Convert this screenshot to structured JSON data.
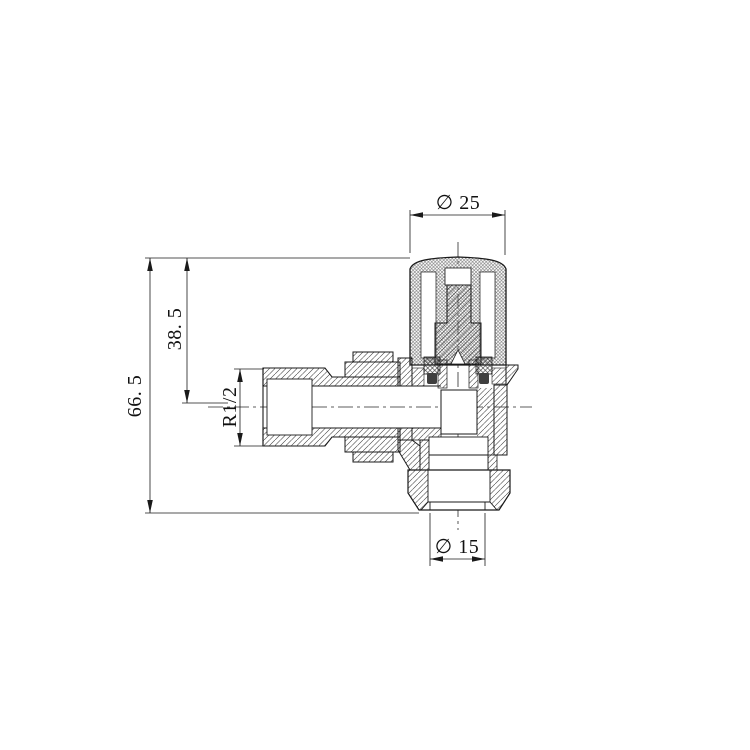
{
  "drawing": {
    "type": "engineering-cross-section",
    "subject": "Angled radiator valve",
    "labels": {
      "top_diameter": "∅ 25",
      "overall_height": "66. 5",
      "upper_height": "38. 5",
      "inlet_thread": "R1/2",
      "bottom_diameter": "∅ 15"
    },
    "values": {
      "top_diameter_mm": 25,
      "overall_height_mm": 66.5,
      "upper_height_mm": 38.5,
      "inlet_thread": "R1/2",
      "bottom_diameter_mm": 15
    },
    "colors": {
      "background": "#ffffff",
      "line": "#1a1a1a",
      "seal": "#3f3f3f"
    }
  }
}
